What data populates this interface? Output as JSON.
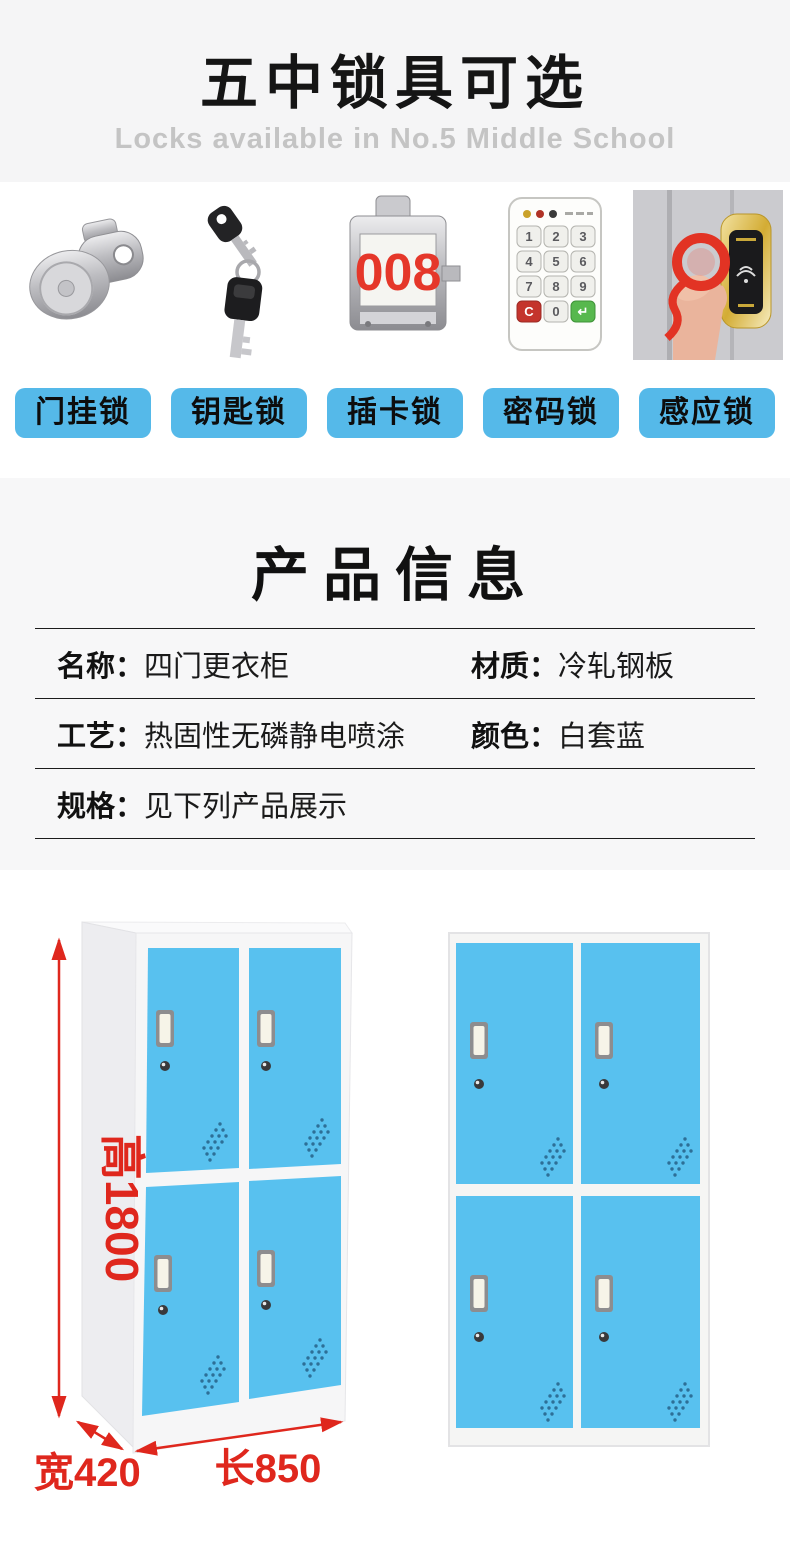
{
  "header": {
    "title": "五中锁具可选",
    "subtitle": "Locks available in No.5 Middle School"
  },
  "locks": {
    "button_color": "#55b9e9",
    "items": [
      {
        "label": "门挂锁",
        "icon": "cam-lock-icon"
      },
      {
        "label": "钥匙锁",
        "icon": "keys-icon"
      },
      {
        "label": "插卡锁",
        "icon": "card-lock-icon",
        "counter": "008"
      },
      {
        "label": "密码锁",
        "icon": "keypad-lock-icon"
      },
      {
        "label": "感应锁",
        "icon": "rfid-lock-icon"
      }
    ],
    "keypad_keys": [
      "1",
      "2",
      "3",
      "4",
      "5",
      "6",
      "7",
      "8",
      "9",
      "C",
      "0",
      "↵"
    ]
  },
  "product_info": {
    "title": "产品信息",
    "rows": [
      {
        "cells": [
          {
            "label": "名称：",
            "value": "四门更衣柜"
          },
          {
            "label": "材质：",
            "value": "冷轧钢板"
          }
        ]
      },
      {
        "cells": [
          {
            "label": "工艺：",
            "value": "热固性无磷静电喷涂"
          },
          {
            "label": "颜色：",
            "value": "白套蓝"
          }
        ]
      },
      {
        "cells": [
          {
            "label": "规格：",
            "value": "见下列产品展示"
          }
        ]
      }
    ]
  },
  "showcase": {
    "door_color": "#58c1ef",
    "dimension_color": "#df271d",
    "height_label": "高1800",
    "width_label": "宽420",
    "length_label": "长850"
  }
}
